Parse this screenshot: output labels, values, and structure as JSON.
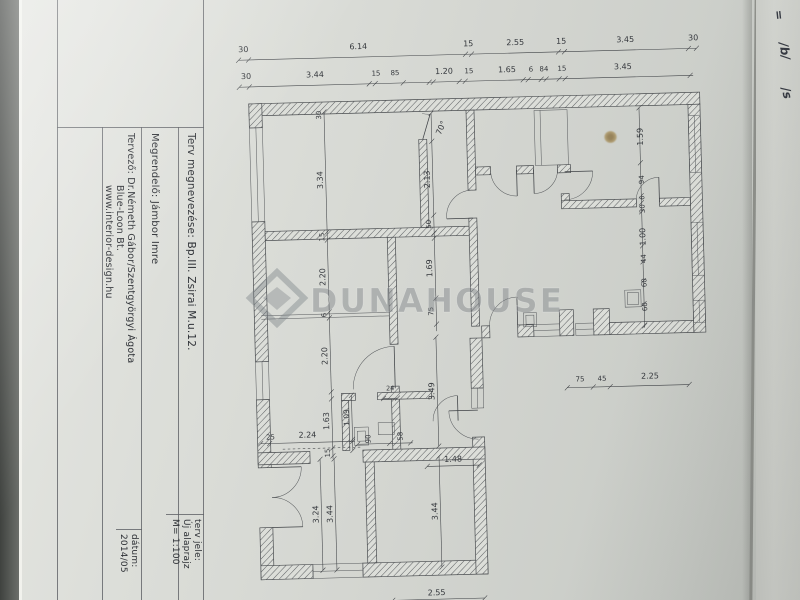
{
  "colors": {
    "paper": "#d8dad5",
    "ink": "#3e4145",
    "watermark_gray": "#767c81",
    "stain_brown": "#8a7140",
    "backdrop_dark": "#3f423f"
  },
  "title_block": {
    "field_plan_name": "Terv megnevezése:  Bp.III.  Zsirai M.u.12.",
    "field_client": "Megrendelő:  Jámbor Imre",
    "field_designer": "Tervező:   Dr.Németh Gábor/Szentgyörgyi Ágota",
    "field_designer_line2": "Blue-Loon Bt.",
    "field_designer_line3": "www.interior-design.hu",
    "plan_type_label": "terv jele:",
    "plan_type_value": "Új alaprajz",
    "scale": "M= 1:100",
    "date_label": "dátum:",
    "date_value": "2014/05"
  },
  "watermark": {
    "text": "DUNAHOUSE"
  },
  "photo": {
    "handwriting": [
      {
        "t": "=",
        "x": 774,
        "y": 8,
        "r": 84
      },
      {
        "t": "/b/",
        "x": 776,
        "y": 44,
        "r": 82
      },
      {
        "t": "/s",
        "x": 781,
        "y": 86,
        "r": 76
      }
    ]
  },
  "plan": {
    "dim_labels": [
      {
        "t": "30",
        "x": 251,
        "y": 46
      },
      {
        "t": "6.14",
        "x": 366,
        "y": 46
      },
      {
        "t": "15",
        "x": 476,
        "y": 46
      },
      {
        "t": "2.55",
        "x": 523,
        "y": 46
      },
      {
        "t": "15",
        "x": 569,
        "y": 46
      },
      {
        "t": "3.45",
        "x": 633,
        "y": 46
      },
      {
        "t": "30",
        "x": 701,
        "y": 46
      },
      {
        "t": "30",
        "x": 253,
        "y": 73
      },
      {
        "t": "3.44",
        "x": 322,
        "y": 73
      },
      {
        "t": "15",
        "x": 383,
        "y": 73,
        "s": 7
      },
      {
        "t": "85",
        "x": 402,
        "y": 73,
        "s": 7
      },
      {
        "t": "1.20",
        "x": 451,
        "y": 73
      },
      {
        "t": "15",
        "x": 476,
        "y": 73,
        "s": 7
      },
      {
        "t": "1.65",
        "x": 514,
        "y": 73
      },
      {
        "t": "6",
        "x": 538,
        "y": 73,
        "s": 7
      },
      {
        "t": "84",
        "x": 551,
        "y": 73,
        "s": 7
      },
      {
        "t": "15",
        "x": 569,
        "y": 73,
        "s": 7
      },
      {
        "t": "3.45",
        "x": 630,
        "y": 73
      },
      {
        "t": "30",
        "x": 327,
        "y": 111,
        "r": -90,
        "s": 7
      },
      {
        "t": "3.34",
        "x": 327,
        "y": 176,
        "r": -90
      },
      {
        "t": "15",
        "x": 327,
        "y": 233,
        "r": -90,
        "s": 7
      },
      {
        "t": "2.20",
        "x": 327,
        "y": 273,
        "r": -90
      },
      {
        "t": "6",
        "x": 327,
        "y": 311,
        "r": -90,
        "s": 7
      },
      {
        "t": "2.20",
        "x": 327,
        "y": 352,
        "r": -90
      },
      {
        "t": "1.63",
        "x": 327,
        "y": 417,
        "r": -90
      },
      {
        "t": "15",
        "x": 327,
        "y": 449,
        "r": -90,
        "s": 7
      },
      {
        "t": "70°",
        "x": 449,
        "y": 128,
        "r": -65
      },
      {
        "t": "2.13",
        "x": 434,
        "y": 178,
        "r": -90
      },
      {
        "t": "50",
        "x": 434,
        "y": 223,
        "r": -90,
        "s": 7
      },
      {
        "t": "1.69",
        "x": 434,
        "y": 267,
        "r": -90
      },
      {
        "t": "75",
        "x": 434,
        "y": 310,
        "r": -90,
        "s": 7
      },
      {
        "t": "1.09",
        "x": 347,
        "y": 414,
        "r": -90,
        "s": 7.5
      },
      {
        "t": "24",
        "x": 389,
        "y": 388,
        "s": 6.5
      },
      {
        "t": "90",
        "x": 368,
        "y": 436,
        "r": -90,
        "s": 7
      },
      {
        "t": "58",
        "x": 400,
        "y": 434,
        "r": -90,
        "s": 7
      },
      {
        "t": "25",
        "x": 268,
        "y": 434,
        "s": 7
      },
      {
        "t": "2.24",
        "x": 305,
        "y": 433
      },
      {
        "t": "3.49",
        "x": 433,
        "y": 390,
        "r": -90
      },
      {
        "t": "1.48",
        "x": 450,
        "y": 461
      },
      {
        "t": "3.24",
        "x": 314,
        "y": 510,
        "r": -90
      },
      {
        "t": "3.44",
        "x": 328,
        "y": 510,
        "r": -90
      },
      {
        "t": "3.44",
        "x": 433,
        "y": 510,
        "r": -90
      },
      {
        "t": "2.55",
        "x": 430,
        "y": 594
      },
      {
        "t": "1.59",
        "x": 648,
        "y": 141,
        "r": -90
      },
      {
        "t": "94",
        "x": 648,
        "y": 184,
        "r": -90,
        "s": 7
      },
      {
        "t": "6",
        "x": 648,
        "y": 202,
        "r": -90,
        "s": 6.5
      },
      {
        "t": "30",
        "x": 648,
        "y": 213,
        "r": -90,
        "s": 7
      },
      {
        "t": "1.00",
        "x": 648,
        "y": 241,
        "r": -90
      },
      {
        "t": "44",
        "x": 648,
        "y": 263,
        "r": -90,
        "s": 7
      },
      {
        "t": "60",
        "x": 648,
        "y": 287,
        "r": -90,
        "s": 7
      },
      {
        "t": "60",
        "x": 648,
        "y": 311,
        "r": -90,
        "s": 7
      },
      {
        "t": "75",
        "x": 579,
        "y": 384,
        "s": 7
      },
      {
        "t": "45",
        "x": 601,
        "y": 384,
        "s": 7
      },
      {
        "t": "2.25",
        "x": 649,
        "y": 383
      }
    ]
  }
}
